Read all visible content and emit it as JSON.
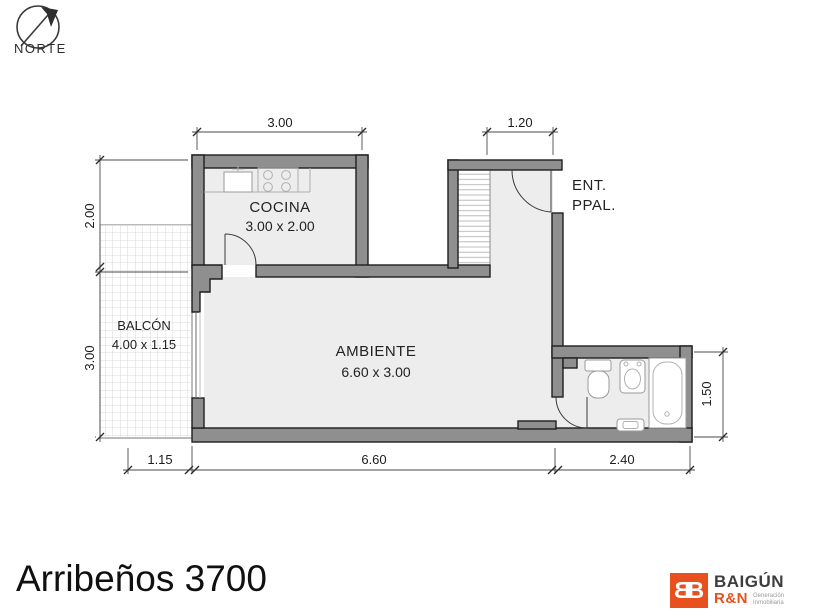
{
  "north": {
    "label": "NORTE"
  },
  "rooms": {
    "cocina": {
      "name": "COCINA",
      "dims": "3.00 x 2.00"
    },
    "ambiente": {
      "name": "AMBIENTE",
      "dims": "6.60 x 3.00"
    },
    "balcon": {
      "name": "BALCÓN",
      "dims": "4.00 x 1.15"
    },
    "entrada": {
      "line1": "ENT.",
      "line2": "PPAL."
    }
  },
  "dimensions": {
    "top_kitchen": "3.00",
    "top_entry": "1.20",
    "left_upper": "2.00",
    "left_lower": "3.00",
    "right_bath": "1.50",
    "bottom_balcony": "1.15",
    "bottom_ambiente": "6.60",
    "bottom_bath": "2.40"
  },
  "title": "Arribeños 3700",
  "logo": {
    "monogram_left": "B",
    "monogram_right": "B",
    "brand": "BAIGÚN",
    "sub": "R&N",
    "tagline_line1": "Generación",
    "tagline_line2": "Inmobiliaria",
    "accent_color": "#e8501e"
  },
  "colors": {
    "wall": "#8f8f8f",
    "floor": "#ededed",
    "ink": "#1e1e1e"
  }
}
